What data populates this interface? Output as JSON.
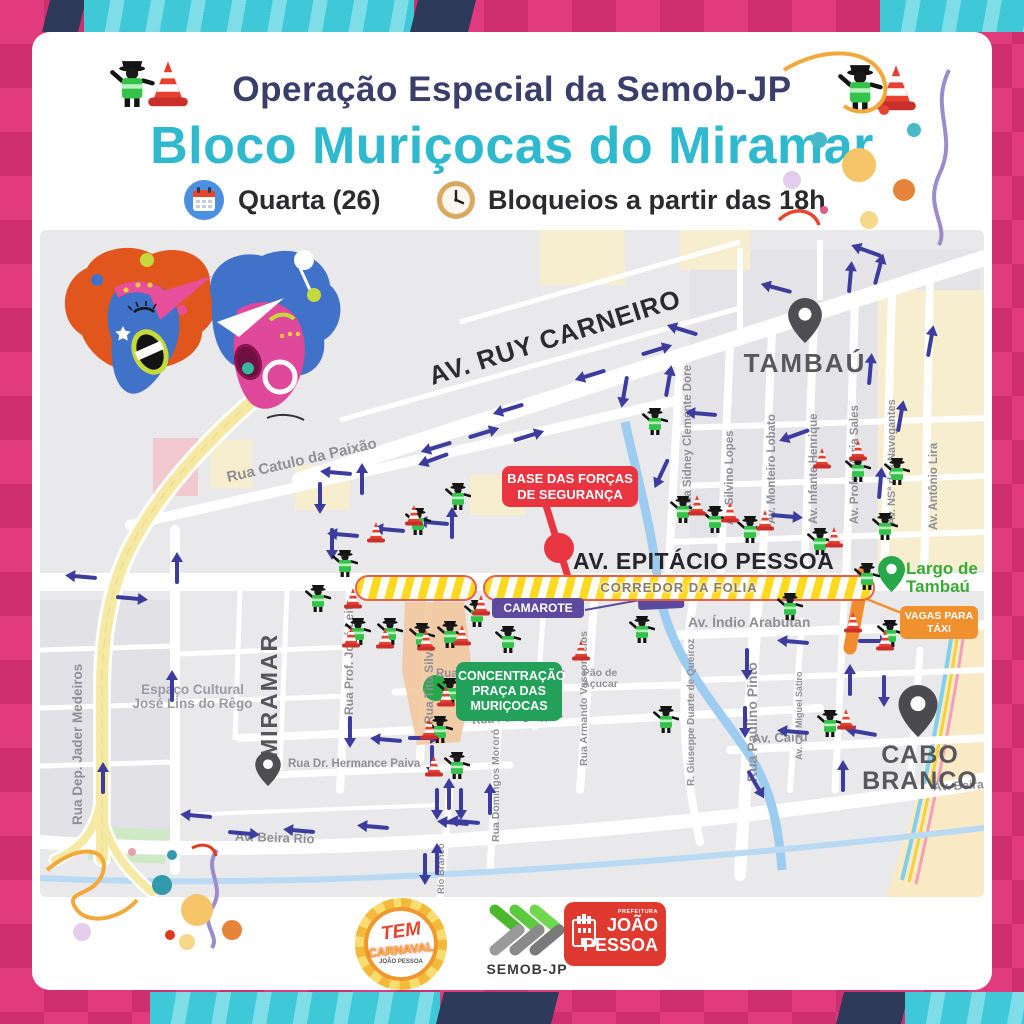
{
  "header": {
    "operation_title": "Operação Especial da Semob-JP",
    "bloco_title": "Bloco Muriçocas do Miramar",
    "date_label": "Quarta (26)",
    "time_label": "Bloqueios a partir das 18h"
  },
  "badges": {
    "security_base": {
      "line1": "BASE DAS FORÇAS",
      "line2": "DE SEGURANÇA"
    },
    "corridor_label": "CORREDOR DA FOLIA",
    "camarote_label": "CAMAROTE",
    "concentration": {
      "line1": "CONCENTRAÇÃO",
      "line2": "PRAÇA DAS",
      "line3": "MURIÇOCAS"
    },
    "taxi": {
      "line1": "VAGAS PARA",
      "line2": "TÁXI"
    }
  },
  "places": {
    "tambau": "TAMBAÚ",
    "miramar": "MIRAMAR",
    "cabo_branco": {
      "line1": "CABO",
      "line2": "BRANCO"
    },
    "largo_tambau": {
      "line1": "Largo de",
      "line2": "Tambaú"
    },
    "espaco_cultural": {
      "line1": "Espaço Cultural",
      "line2": "José Lins do Rêgo"
    },
    "pao_de_acucar": {
      "line1": "Pão de",
      "line2": "Açucar"
    }
  },
  "streets": {
    "ruy_carneiro": "AV. RUY CARNEIRO",
    "epitacio_pessoa": "AV. EPITÁCIO PESSOA",
    "catulo_da_paixao": "Rua Catulo da Paixão",
    "jader_medeiros": "Rua Dep. Jader Medeiros",
    "jose_leite": "Rua Prof. José Leite",
    "tito_silva": "Rua Tito Silva",
    "sidney_clemente": "Rua Sidney Clemente Dore",
    "silvino_lopes": "Av. Silvino Lopes",
    "monteiro_lobato": "Av. Monteiro Lobato",
    "infante_henrique": "Av. Infante Henrique",
    "maria_sales": "Av. Profa. Maria Sales",
    "navegantes": "Av. NSª dos Navegantes",
    "antonio_lira": "Av. Antônio Lira",
    "indio_arabutan": "Av. Índio Arabutan",
    "paulino_pinto": "Rua Paulino Pinto",
    "miguel_satiro": "Av. Cel Miguel Sátiro",
    "cairu": "Av. Cairú",
    "geraldo_mariz": "Rua Dep. Geraldo Mariz",
    "padre_ayres": "Rua Padre Ayres",
    "hermance_paiva": "Rua Dr. Hermance Paiva",
    "domingos_mororo": "Rua Domingos Mororó",
    "armando_vasconcelos": "Rua Armando Vasconcelos",
    "giuseppe_duarte": "R. Giuseppe Duarte de Queiroz",
    "beira_rio": "Av. Beira Rio",
    "beira_rio_2": "Av. Beira Rio",
    "rio_branco": "Rio Branco"
  },
  "footer": {
    "tem_carnaval": {
      "line1": "TEM",
      "line2": "CARNAVAL",
      "sub": "JOÃO PESSOA"
    },
    "semob": "SEMOB-JP",
    "prefeitura": {
      "top": "PREFEITURA",
      "line1": "JOÃO",
      "line2": "PESSOA"
    }
  },
  "icons": {
    "traffic_agent": "traffic-agent-icon",
    "traffic_cone": "traffic-cone-icon",
    "direction_arrow": "direction-arrow-icon",
    "location_pin": "location-pin-icon",
    "calendar": "calendar-icon",
    "clock": "clock-icon"
  },
  "colors": {
    "title_navy": "#393e6b",
    "title_cyan": "#2fb9cf",
    "badge_red": "#e8353f",
    "badge_green": "#23a05a",
    "badge_purple": "#5b4a9e",
    "badge_orange": "#f09130",
    "corridor_yellow": "#ffd91e",
    "arrow_blue": "#3c3c9e",
    "pin_green": "#27a84a",
    "border_pink": "#e23a7f",
    "border_teal": "#37c6d8",
    "border_navy": "#2e3a59"
  }
}
